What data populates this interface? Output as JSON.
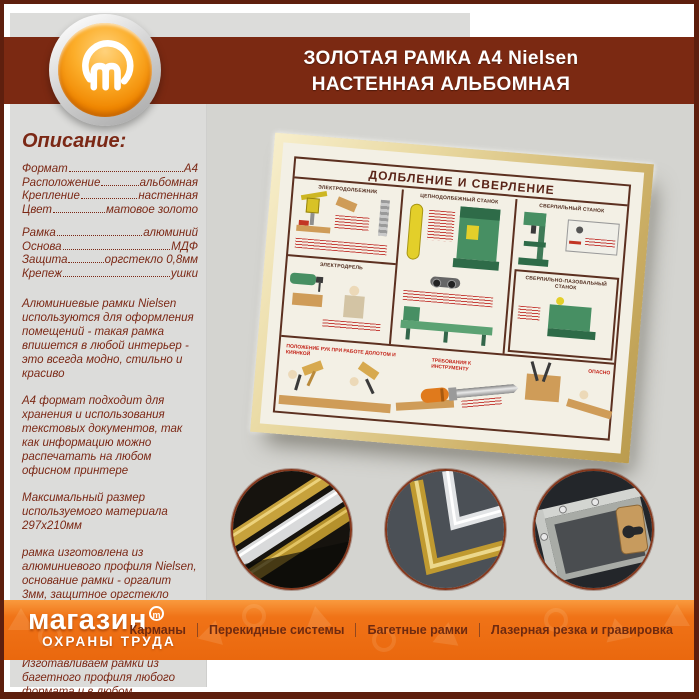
{
  "colors": {
    "accent_orange": "#f07317",
    "brand_brown": "#7b2912",
    "border_brown": "#5e1f0e",
    "panel_gray": "#dcdcda",
    "wall_gray": "#d4d4d0",
    "frame_gold": "#d7bd7a"
  },
  "header": {
    "title_line1": "ЗОЛОТАЯ РАМКА А4 Nielsen",
    "title_line2": "НАСТЕННАЯ АЛЬБОМНАЯ"
  },
  "logo": {
    "icon": "magazin-m-icon"
  },
  "sidebar": {
    "heading": "Описание:",
    "specs": [
      {
        "label": "Формат",
        "value": "А4"
      },
      {
        "label": "Расположение",
        "value": "альбомная"
      },
      {
        "label": "Крепление",
        "value": "настенная"
      },
      {
        "label": "Цвет",
        "value": "матовое золото"
      },
      {
        "label": "Рамка",
        "value": "алюминий"
      },
      {
        "label": "Основа",
        "value": "МДФ"
      },
      {
        "label": "Защита",
        "value": "оргстекло 0,8мм"
      },
      {
        "label": "Крепеж",
        "value": "ушки"
      }
    ],
    "paragraphs": [
      "Алюминиевые рамки Nielsen используются для оформления помещений - такая рамка впишется в любой интерьер - это всегда модно, стильно и красиво",
      "А4 формат подходит для хранения и использования текстовых документов, так как информацию можно распечатать на любом офисном принтере",
      "Максимальный размер используемого материала 297х210мм",
      "рамка изготовлена из алюминиевого профиля Nielsen, основание рамки - оргалит 3мм, защитное оргстекло толщиной 0,8мм, пружины для фиксации, скрытые ушки для крепления на стену",
      "Изготавливаем рамки из багетного профиля любого формата и в любом количестве"
    ]
  },
  "poster": {
    "title": "ДОЛБЛЕНИЕ И СВЕРЛЕНИЕ",
    "sections": [
      "ЭЛЕКТРОДОЛБЕЖНИК",
      "ЭЛЕКТРОДРЕЛЬ",
      "ЦЕПНОДОЛБЕЖНЫЙ СТАНОК",
      "СВЕРЛИЛЬНЫЙ СТАНОК",
      "СВЕРЛИЛЬНО-ПАЗОВАЛЬНЫЙ СТАНОК"
    ],
    "bottom_labels": [
      "ПОЛОЖЕНИЕ РУК ПРИ РАБОТЕ ДОЛОТОМ И КИЯНКОЙ",
      "ТРЕБОВАНИЯ К ИНСТРУМЕНТУ",
      "ОПАСНО"
    ]
  },
  "detail_photos": [
    {
      "icon": "aluminum-profiles-photo"
    },
    {
      "icon": "frame-corners-photo"
    },
    {
      "icon": "frame-back-hangers-photo"
    }
  ],
  "footer": {
    "brand_line1": "магазин",
    "brand_mark": "m",
    "brand_line2": "ОХРАНЫ ТРУДА",
    "nav": [
      "Карманы",
      "Перекидные системы",
      "Багетные рамки",
      "Лазерная резка и гравировка"
    ]
  }
}
